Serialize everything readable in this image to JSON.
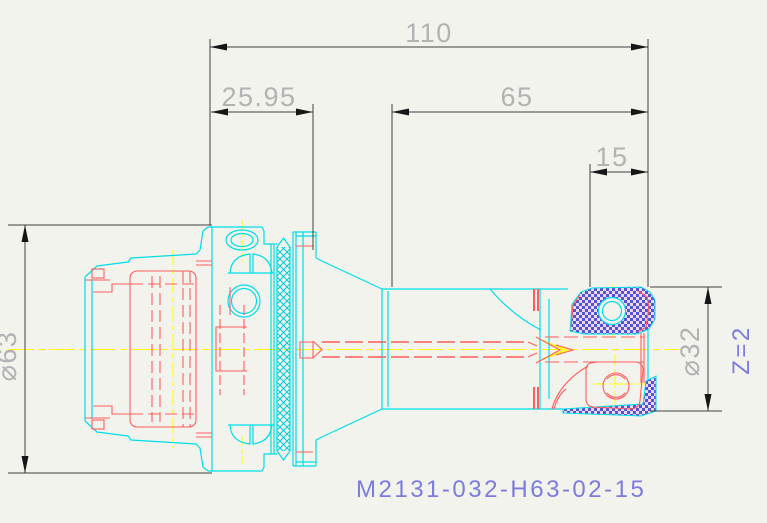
{
  "part_label": "M2131-032-H63-02-15",
  "flute_label": "Z=2",
  "dims": {
    "overall_length": "110",
    "gauge_length": "25.95",
    "projection_length": "65",
    "insert_length": "15",
    "shank_diameter": "⌀63",
    "cutter_diameter": "⌀32"
  },
  "colors": {
    "background": "#f3f3ee",
    "outline": "#00dde8",
    "hidden": "#ff5c5c",
    "centerline": "#ffff00",
    "dimension_line": "#3f3f3f",
    "dimension_text": "#b2b2b2",
    "arrow": "#161616",
    "annotation": "#7b7be0",
    "hatch": "#00ccd8",
    "insert_blue": "#5353d6",
    "insert_pink": "#edd7ee"
  }
}
